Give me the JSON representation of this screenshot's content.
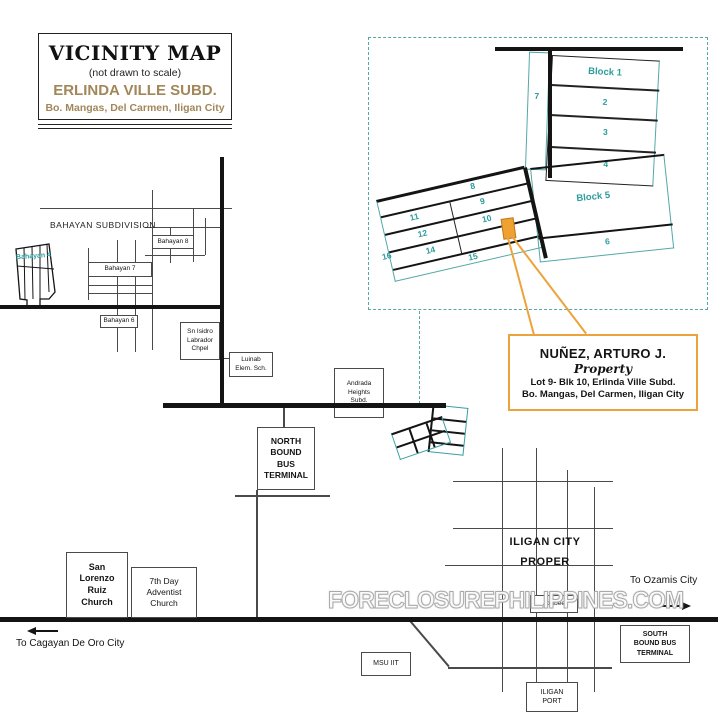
{
  "title_box": {
    "title": "VICINITY MAP",
    "subtitle": "(not drawn to scale)",
    "subdivision": "ERLINDA VILLE SUBD.",
    "location": "Bo. Mangas, Del Carmen, Iligan City"
  },
  "plat": {
    "block1": "Block 1",
    "block5": "Block 5",
    "lot2": "2",
    "lot3": "3",
    "lot4": "4",
    "lot6": "6",
    "lot7": "7",
    "lot8": "8",
    "lot9": "9",
    "lot10": "10",
    "lot11": "11",
    "lot12": "12",
    "lot14": "14",
    "lot15": "15",
    "lot16": "16"
  },
  "property_box": {
    "owner": "NUÑEZ, ARTURO J.",
    "label": "Property",
    "line1": "Lot 9- Blk 10, Erlinda Ville Subd.",
    "line2": "Bo. Mangas, Del Carmen, Iligan City"
  },
  "landmarks": {
    "bahayan_subdivision": "BAHAYAN SUBDIVISION",
    "bahayan8": "Bahayan 8",
    "bahayan7": "Bahayan 7",
    "bahayan6": "Bahayan 6",
    "bahayan4": "Bahayan 4",
    "chapel": [
      "Sn Isidro",
      "Labrador",
      "Chpel"
    ],
    "school": [
      "Luinab",
      "Elem. Sch."
    ],
    "andrada": [
      "Andrada",
      "Heights",
      "Subd."
    ],
    "north_terminal": [
      "NORTH",
      "BOUND",
      "BUS",
      "TERMINAL"
    ],
    "south_terminal": [
      "SOUTH",
      "BOUND BUS",
      "TERMINAL"
    ],
    "city_proper": [
      "ILIGAN CITY",
      "PROPER"
    ],
    "slr_church": [
      "San",
      "Lorenzo",
      "Ruiz",
      "Church"
    ],
    "adventist_church": [
      "7th Day",
      "Adventist",
      "Church"
    ],
    "msu": "MSU IIT",
    "jollibee": "Jollibee",
    "port": [
      "ILIGAN",
      "PORT"
    ]
  },
  "directions": {
    "ozamis": "To Ozamis City",
    "cagayan": "To Cagayan De Oro City"
  },
  "watermark": "FORECLOSUREPHILIPPINES.COM",
  "colors": {
    "teal": "#2d9c9c",
    "orange": "#eda33c",
    "tan": "#a1875a",
    "line": "#141414"
  }
}
